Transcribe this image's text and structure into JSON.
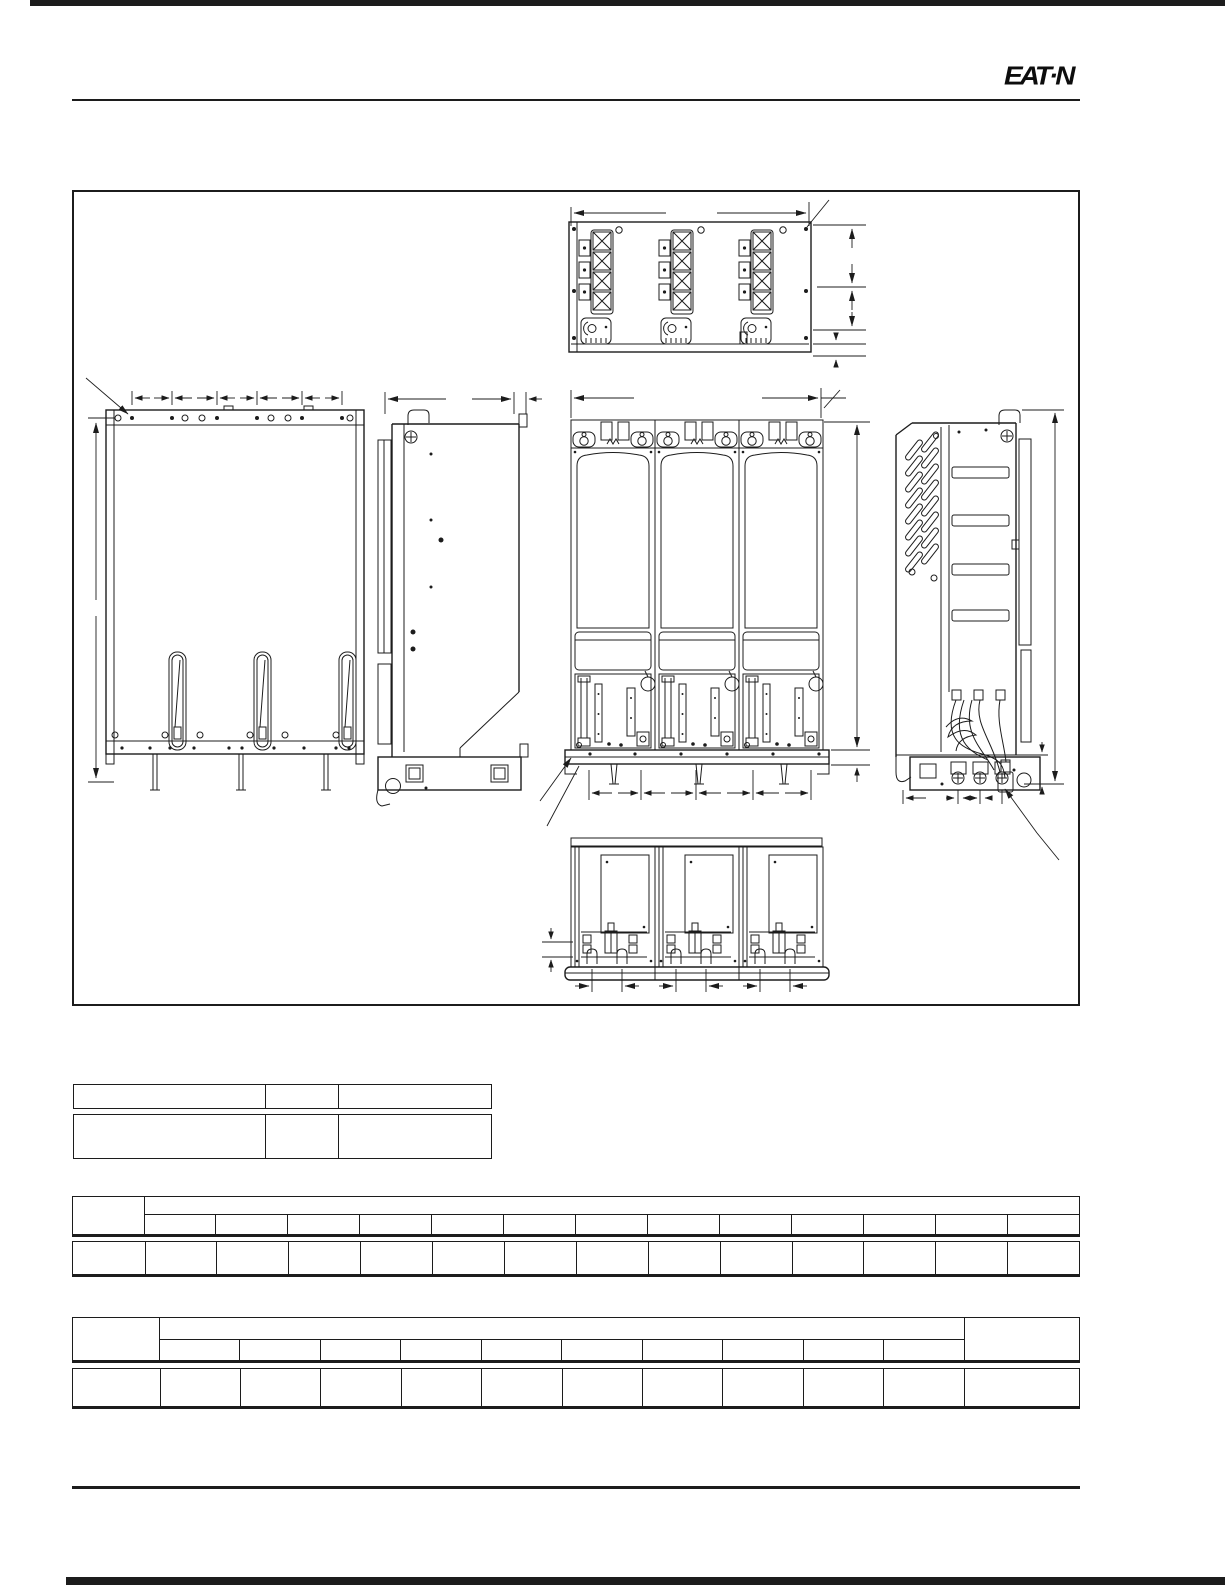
{
  "page": {
    "background_color": "#ffffff",
    "ink_color": "#1c1c1c"
  },
  "header": {
    "brand": "Eaton",
    "logo_text": "EAT·N"
  },
  "drawing": {
    "views": [
      {
        "id": "top-view"
      },
      {
        "id": "back-panel-view"
      },
      {
        "id": "left-side-view"
      },
      {
        "id": "front-view"
      },
      {
        "id": "right-side-view"
      },
      {
        "id": "bottom-view"
      }
    ]
  },
  "tables": {
    "summary_table": {
      "col_widths": [
        191,
        73,
        155
      ],
      "rows": [
        {
          "cells": [
            "",
            "",
            ""
          ]
        },
        {
          "cells": [
            "",
            "",
            ""
          ]
        }
      ]
    },
    "wide_table_1": {
      "corner_cell": "",
      "group_header": "",
      "sub_headers": [
        "",
        "",
        "",
        "",
        "",
        "",
        "",
        "",
        "",
        "",
        "",
        "",
        ""
      ],
      "body_row": [
        "",
        "",
        "",
        "",
        "",
        "",
        "",
        "",
        "",
        "",
        "",
        "",
        "",
        ""
      ]
    },
    "wide_table_2": {
      "corner_cell": "",
      "group_header": "",
      "last_col_header": "",
      "sub_headers": [
        "",
        "",
        "",
        "",
        "",
        "",
        "",
        "",
        "",
        ""
      ],
      "body_row": [
        "",
        "",
        "",
        "",
        "",
        "",
        "",
        "",
        "",
        "",
        "",
        ""
      ]
    }
  }
}
